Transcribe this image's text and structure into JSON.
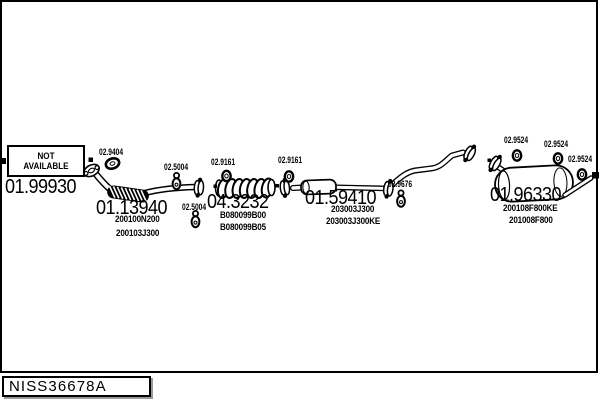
{
  "title_block": {
    "code": "NISS36678A"
  },
  "not_available": {
    "text": "NOT AVAILABLE"
  },
  "part_labels": {
    "big": [
      {
        "text": "01.99930",
        "x": 5,
        "y": 177
      },
      {
        "text": "01.13940",
        "x": 96,
        "y": 198
      },
      {
        "text": "04.3232",
        "x": 207,
        "y": 192
      },
      {
        "text": "01.59410",
        "x": 305,
        "y": 188
      },
      {
        "text": "01.96330",
        "x": 490,
        "y": 185
      }
    ],
    "small": [
      {
        "text": "02.9404",
        "x": 99,
        "y": 148
      },
      {
        "text": "02.5004",
        "x": 164,
        "y": 163
      },
      {
        "text": "02.5004",
        "x": 182,
        "y": 203
      },
      {
        "text": "02.9161",
        "x": 211,
        "y": 158
      },
      {
        "text": "02.9161",
        "x": 278,
        "y": 156
      },
      {
        "text": "02.9676",
        "x": 388,
        "y": 180
      },
      {
        "text": "02.9524",
        "x": 504,
        "y": 136
      },
      {
        "text": "02.9524",
        "x": 544,
        "y": 140
      },
      {
        "text": "02.9524",
        "x": 568,
        "y": 155
      }
    ],
    "sub": [
      {
        "text": "200100N200",
        "x": 115,
        "y": 215
      },
      {
        "text": "200103J300",
        "x": 116,
        "y": 229
      },
      {
        "text": "B080099B00",
        "x": 220,
        "y": 211
      },
      {
        "text": "B080099B05",
        "x": 220,
        "y": 223
      },
      {
        "text": "203003J300",
        "x": 331,
        "y": 205
      },
      {
        "text": "203003J300KE",
        "x": 326,
        "y": 217
      },
      {
        "text": "200108F800KE",
        "x": 503,
        "y": 204
      },
      {
        "text": "201008F800",
        "x": 509,
        "y": 216
      }
    ]
  },
  "icons": [
    "flange-icon",
    "gasket-ring-icon",
    "rubber-hanger-icon",
    "flex-pipe-icon",
    "catalytic-converter-icon",
    "center-resonator-icon",
    "rear-muffler-icon",
    "inlet-end-marker",
    "tailpipe-end-marker"
  ],
  "colors": {
    "ink": "#000000",
    "paper": "#ffffff",
    "box_shadow": "#999999"
  }
}
